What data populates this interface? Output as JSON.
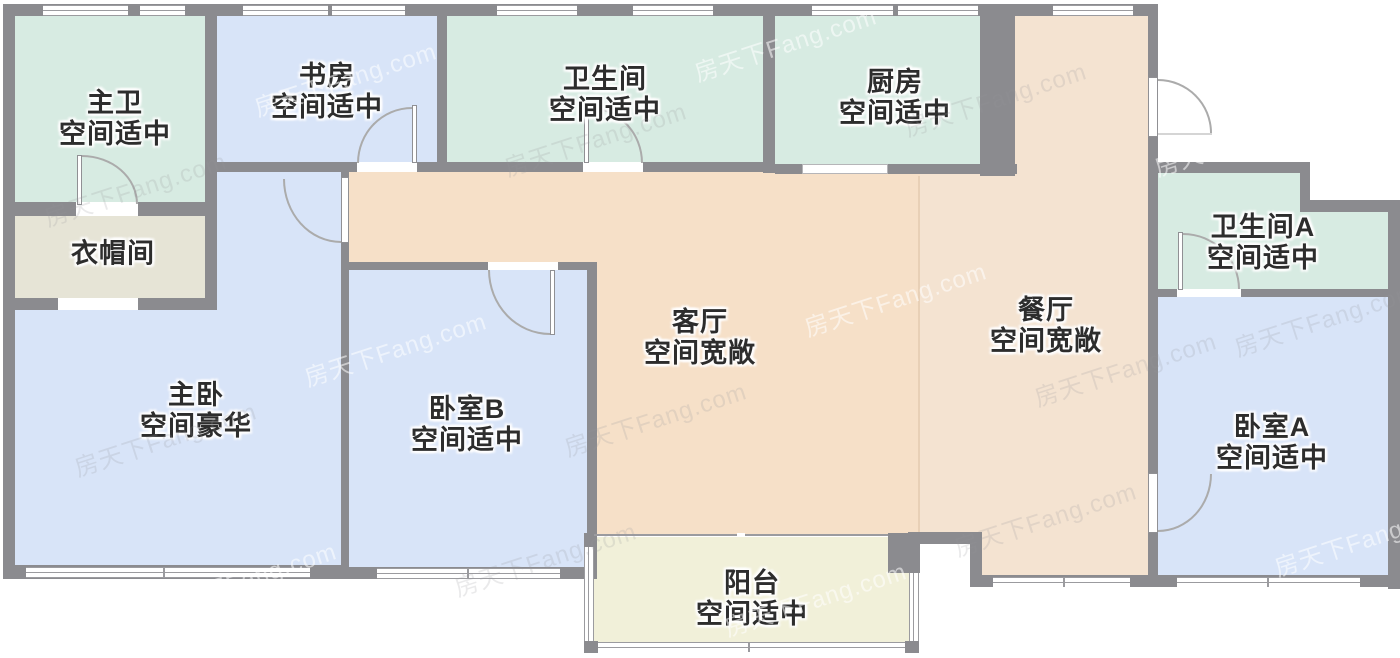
{
  "palette": {
    "wall": "#8b8b8f",
    "green": "#d7ebe2",
    "blue": "#d8e4f8",
    "living": "#f6e0c8",
    "dining": "#f4e3d1",
    "beige": "#e6e4d6",
    "cream": "#f1f0d9"
  },
  "watermark": {
    "text": "房天下Fang.com"
  },
  "rooms": {
    "master_bath": {
      "name": "主卫",
      "condition": "空间适中"
    },
    "cloakroom": {
      "name": "衣帽间"
    },
    "study": {
      "name": "书房",
      "condition": "空间适中"
    },
    "bathroom": {
      "name": "卫生间",
      "condition": "空间适中"
    },
    "kitchen": {
      "name": "厨房",
      "condition": "空间适中"
    },
    "bathroom_a": {
      "name": "卫生间A",
      "condition": "空间适中"
    },
    "living": {
      "name": "客厅",
      "condition": "空间宽敞"
    },
    "dining": {
      "name": "餐厅",
      "condition": "空间宽敞"
    },
    "master_bedroom": {
      "name": "主卧",
      "condition": "空间豪华"
    },
    "bedroom_b": {
      "name": "卧室B",
      "condition": "空间适中"
    },
    "bedroom_a": {
      "name": "卧室A",
      "condition": "空间适中"
    },
    "balcony": {
      "name": "阳台",
      "condition": "空间适中"
    }
  }
}
